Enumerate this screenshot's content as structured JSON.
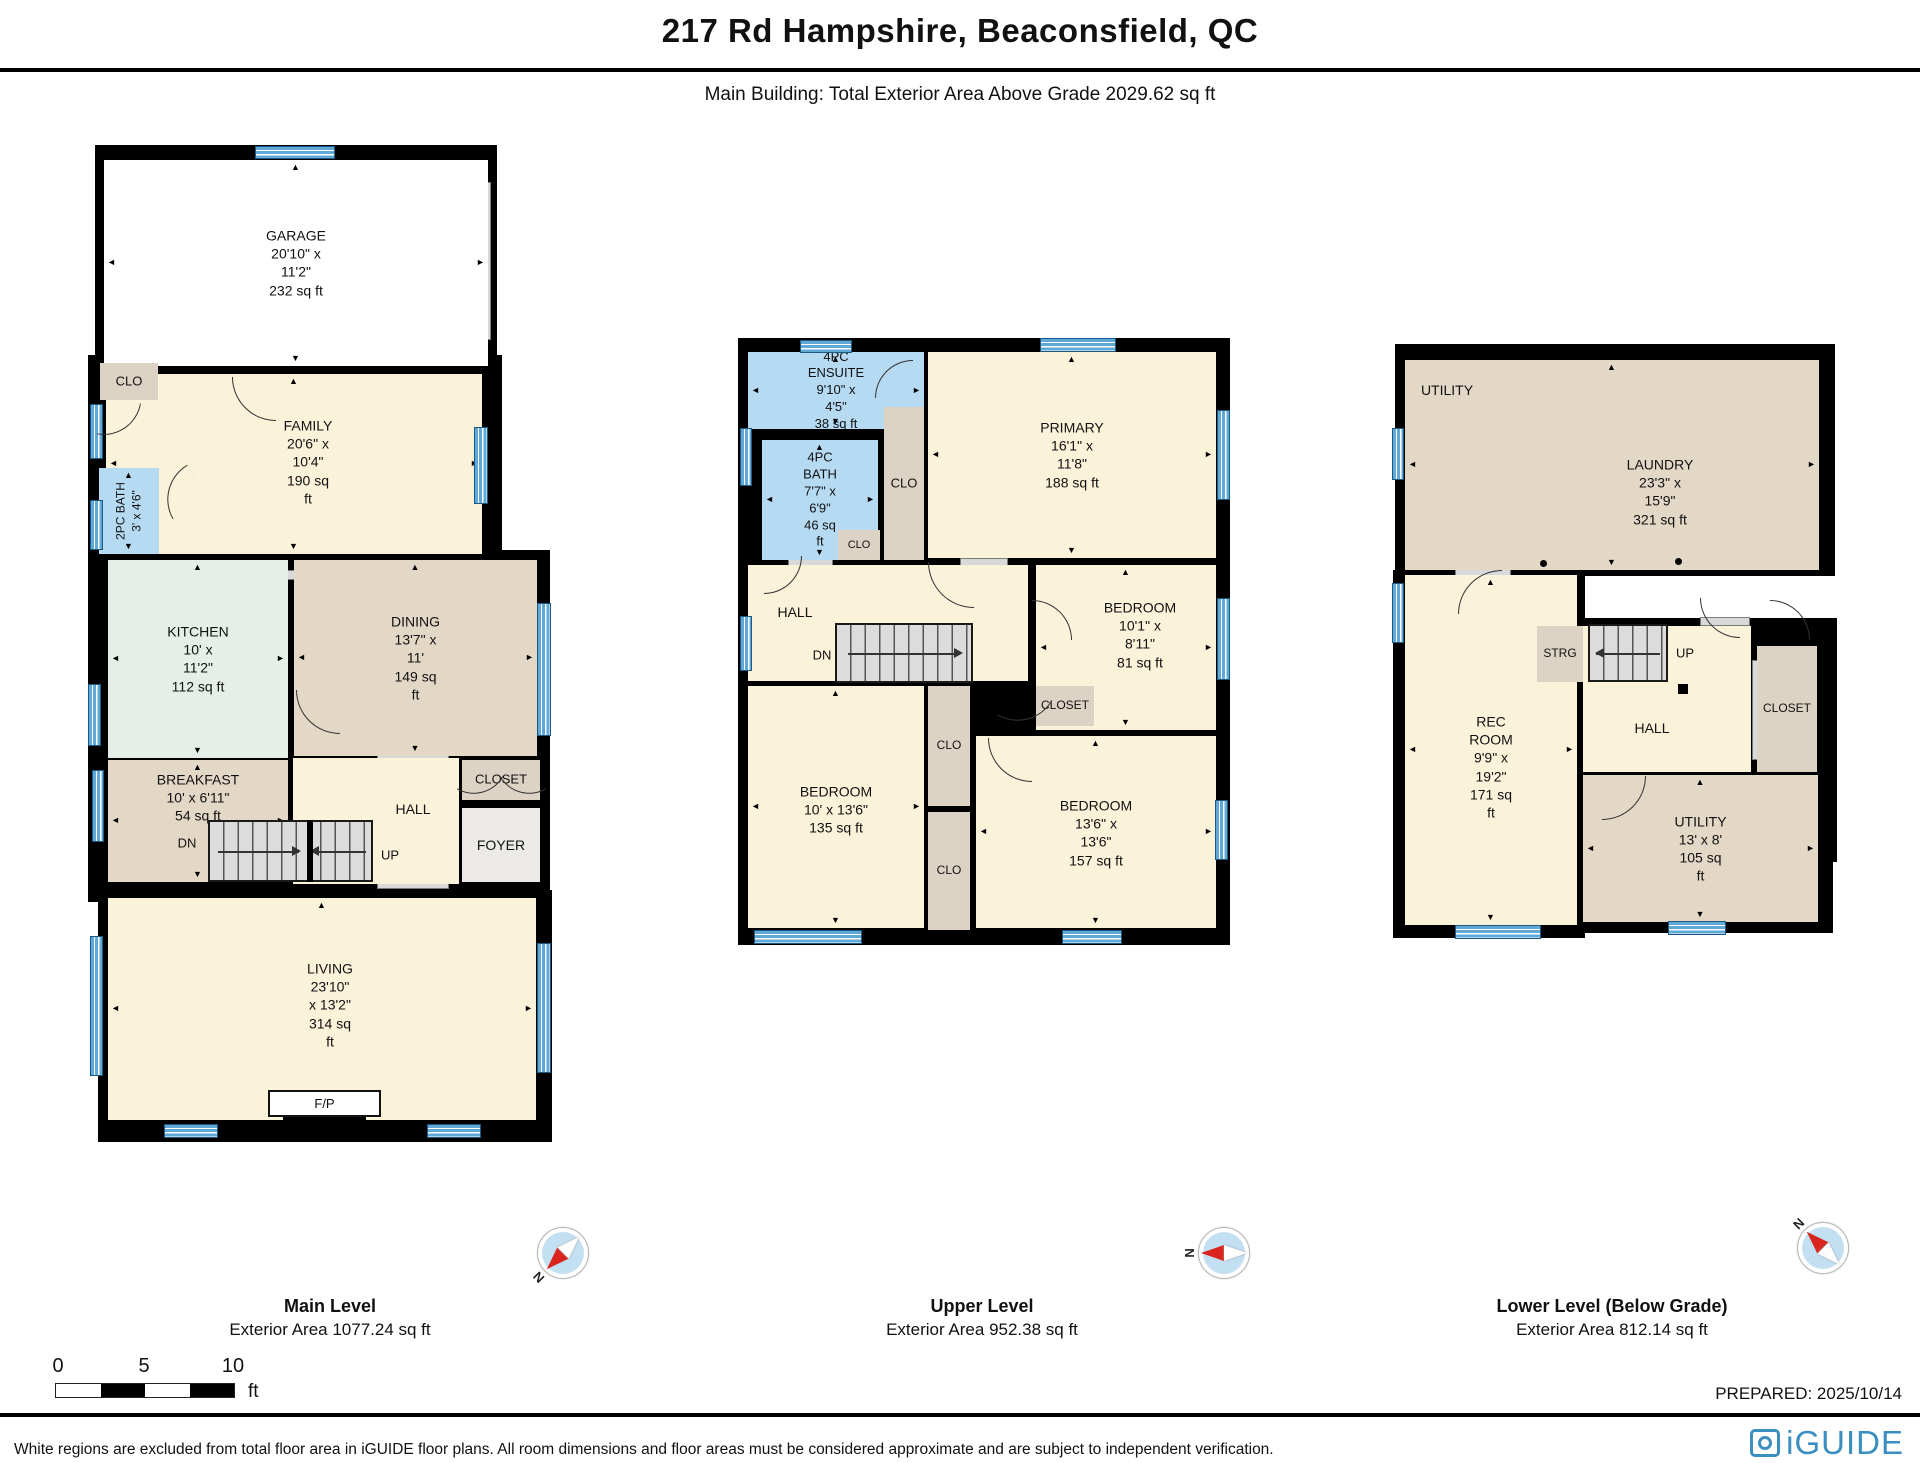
{
  "header": {
    "title": "217 Rd Hampshire, Beaconsfield, QC",
    "subtitle": "Main Building: Total Exterior Area Above Grade 2029.62 sq ft"
  },
  "colors": {
    "wall": "#000000",
    "white": "#ffffff",
    "cream": "#fbf2da",
    "tan": "#e3d8c6",
    "closet": "#ddd3c5",
    "mint": "#e6eee8",
    "blue": "#b5daf2",
    "gray": "#eceae6",
    "window_blue": "#5fa8d8",
    "accent_red": "#d9251d",
    "brand_blue": "#3a8fc0"
  },
  "compass_n": "N",
  "scale_bar": {
    "t0": "0",
    "t1": "5",
    "t2": "10",
    "unit": "ft"
  },
  "prepared": "PREPARED: 2025/10/14",
  "footer": {
    "disclaimer": "White regions are excluded from total floor area in iGUIDE floor plans. All room dimensions and floor areas must be considered approximate and are subject to independent verification.",
    "logo_text": "iGUIDE"
  },
  "levels": [
    {
      "id": "main",
      "caption": {
        "name": "Main Level",
        "area": "Exterior Area 1077.24 sq ft"
      },
      "backdrops": [
        [
          95,
          145,
          402,
          230
        ],
        [
          88,
          355,
          414,
          230
        ],
        [
          88,
          550,
          462,
          352
        ],
        [
          98,
          890,
          454,
          252
        ]
      ],
      "rooms": [
        {
          "n": "garage",
          "r": [
            104,
            160,
            384,
            206
          ],
          "f": "white",
          "l": [
            "GARAGE",
            "20'10\" x 11'2\"",
            "232 sq ft"
          ],
          "a": 1
        },
        {
          "n": "family",
          "r": [
            106,
            374,
            376,
            180
          ],
          "f": "cream",
          "l": [
            "FAMILY",
            "20'6\" x 10'4\"",
            "190 sq ft"
          ],
          "a": 1,
          "lx": 308,
          "ly": 462
        },
        {
          "n": "clo-main",
          "r": [
            100,
            363,
            58,
            37
          ],
          "f": "closet",
          "l": [
            "CLO"
          ],
          "fs": 13
        },
        {
          "n": "2pc-bath",
          "r": [
            99,
            468,
            60,
            86
          ],
          "f": "blue",
          "l": [
            "2PC BATH",
            "3' x 4'6\""
          ],
          "fs": 12,
          "v": 1,
          "a": 2
        },
        {
          "n": "kitchen",
          "r": [
            108,
            560,
            180,
            198
          ],
          "f": "mint",
          "l": [
            "KITCHEN",
            "10' x 11'2\"",
            "112 sq ft"
          ],
          "a": 1
        },
        {
          "n": "dining",
          "r": [
            294,
            560,
            243,
            196
          ],
          "f": "tan",
          "l": [
            "DINING",
            "13'7\" x 11'",
            "149 sq ft"
          ],
          "a": 1
        },
        {
          "n": "breakfast",
          "r": [
            108,
            760,
            180,
            122
          ],
          "f": "tan",
          "l": [
            "BREAKFAST",
            "10' x 6'11\"",
            "54 sq ft"
          ],
          "a": 1,
          "ly": 798
        },
        {
          "n": "hall-main",
          "r": [
            293,
            758,
            166,
            126
          ],
          "f": "cream",
          "l": [
            "HALL"
          ],
          "lx": 413,
          "ly": 809
        },
        {
          "n": "closet-main",
          "r": [
            462,
            760,
            78,
            40
          ],
          "f": "closet",
          "l": [
            "CLOSET"
          ],
          "fs": 13
        },
        {
          "n": "foyer",
          "r": [
            462,
            808,
            78,
            74
          ],
          "f": "gray",
          "l": [
            "FOYER"
          ],
          "ly": 845
        },
        {
          "n": "living",
          "r": [
            108,
            898,
            428,
            222
          ],
          "f": "cream",
          "l": [
            "LIVING",
            "23'10\" x 13'2\"",
            "314 sq ft"
          ],
          "a": 1,
          "lx": 330,
          "ly": 1005
        }
      ],
      "windows": [
        [
          255,
          146,
          80,
          13
        ],
        [
          90,
          404,
          13,
          55
        ],
        [
          90,
          500,
          13,
          50
        ],
        [
          88,
          684,
          13,
          62
        ],
        [
          92,
          770,
          12,
          72
        ],
        [
          90,
          936,
          13,
          140
        ],
        [
          474,
          427,
          14,
          77
        ],
        [
          537,
          603,
          14,
          133
        ],
        [
          537,
          943,
          14,
          130
        ],
        [
          164,
          1124,
          54,
          14
        ],
        [
          427,
          1124,
          54,
          14
        ]
      ],
      "grays": [
        [
          478,
          182,
          13,
          158
        ],
        [
          158,
          344,
          52,
          18
        ],
        [
          262,
          570,
          58,
          10
        ],
        [
          377,
          750,
          72,
          9
        ],
        [
          377,
          880,
          72,
          9
        ]
      ],
      "stairs": [
        {
          "r": [
            208,
            820,
            165,
            62
          ],
          "flights": [
            {
              "dir": "right",
              "w": 0.6
            },
            {
              "dir": "left",
              "w": 0.4
            }
          ],
          "div": 0.6
        }
      ],
      "texts": [
        {
          "t": "DN",
          "x": 187,
          "y": 843
        },
        {
          "t": "UP",
          "x": 390,
          "y": 855
        }
      ],
      "arcs": [
        [
          232,
          377,
          44,
          0
        ],
        [
          100,
          400,
          38,
          280
        ],
        [
          160,
          472,
          40,
          60
        ],
        [
          296,
          690,
          44,
          0
        ],
        [
          463,
          766,
          34,
          300
        ],
        [
          506,
          766,
          34,
          330
        ]
      ],
      "fp": {
        "box": [
          268,
          1090,
          113,
          27
        ],
        "strip": [
          283,
          1117,
          83,
          14
        ],
        "label": "F/P"
      },
      "posts": [],
      "dots": []
    },
    {
      "id": "upper",
      "caption": {
        "name": "Upper Level",
        "area": "Exterior Area 952.38 sq ft"
      },
      "backdrops": [
        [
          738,
          338,
          492,
          607
        ]
      ],
      "rooms": [
        {
          "n": "ensuite",
          "r": [
            748,
            352,
            176,
            77
          ],
          "f": "blue",
          "l": [
            "4PC ENSUITE",
            "9'10\" x 4'5\"",
            "38 sq ft"
          ],
          "fs": 13,
          "a": 1
        },
        {
          "n": "4pc-bath",
          "r": [
            762,
            440,
            116,
            120
          ],
          "f": "blue",
          "l": [
            "4PC BATH",
            "7'7\" x 6'9\"",
            "46 sq ft"
          ],
          "fs": 13,
          "a": 1
        },
        {
          "n": "clo-vert",
          "r": [
            884,
            407,
            40,
            153
          ],
          "f": "closet",
          "l": [
            "CLO"
          ],
          "fs": 13
        },
        {
          "n": "clo-small",
          "r": [
            838,
            530,
            42,
            30
          ],
          "f": "closet",
          "l": [
            "CLO"
          ],
          "fs": 11
        },
        {
          "n": "primary",
          "r": [
            928,
            352,
            288,
            206
          ],
          "f": "cream",
          "l": [
            "PRIMARY",
            "16'1\" x 11'8\"",
            "188 sq ft"
          ],
          "a": 1
        },
        {
          "n": "hall-upper",
          "r": [
            748,
            565,
            280,
            116
          ],
          "f": "cream",
          "l": [
            "HALL"
          ],
          "lx": 795,
          "ly": 612
        },
        {
          "n": "bedroom-small",
          "r": [
            1036,
            565,
            180,
            165
          ],
          "f": "cream",
          "l": [
            "BEDROOM",
            "10'1\" x 8'11\"",
            "81 sq ft"
          ],
          "a": 1,
          "lx": 1140,
          "ly": 635
        },
        {
          "n": "closet-upper",
          "r": [
            1036,
            686,
            58,
            40
          ],
          "f": "closet",
          "l": [
            "CLOSET"
          ],
          "fs": 12
        },
        {
          "n": "clo-mid1",
          "r": [
            928,
            686,
            42,
            120
          ],
          "f": "closet",
          "l": [
            "CLO"
          ],
          "fs": 12
        },
        {
          "n": "clo-mid2",
          "r": [
            928,
            812,
            42,
            118
          ],
          "f": "closet",
          "l": [
            "CLO"
          ],
          "fs": 12
        },
        {
          "n": "bedroom-left",
          "r": [
            748,
            686,
            176,
            242
          ],
          "f": "cream",
          "l": [
            "BEDROOM",
            "10' x 13'6\"",
            "135 sq ft"
          ],
          "a": 1,
          "ly": 810
        },
        {
          "n": "bedroom-big",
          "r": [
            976,
            736,
            240,
            192
          ],
          "f": "cream",
          "l": [
            "BEDROOM",
            "13'6\" x 13'6\"",
            "157 sq ft"
          ],
          "a": 1,
          "ly": 833
        }
      ],
      "windows": [
        [
          800,
          340,
          52,
          13
        ],
        [
          1040,
          338,
          76,
          14
        ],
        [
          740,
          428,
          12,
          58
        ],
        [
          740,
          616,
          12,
          55
        ],
        [
          1217,
          410,
          13,
          90
        ],
        [
          1217,
          598,
          13,
          82
        ],
        [
          1215,
          800,
          13,
          60
        ],
        [
          754,
          930,
          108,
          14
        ],
        [
          1062,
          930,
          60,
          14
        ]
      ],
      "grays": [
        [
          788,
          558,
          45,
          9
        ],
        [
          960,
          558,
          48,
          9
        ],
        [
          1040,
          680,
          50,
          8
        ]
      ],
      "stairs": [
        {
          "r": [
            835,
            623,
            138,
            60
          ],
          "flights": [
            {
              "dir": "right",
              "w": 1
            }
          ]
        }
      ],
      "texts": [
        {
          "t": "DN",
          "x": 822,
          "y": 655
        }
      ],
      "arcs": [
        [
          928,
          562,
          46,
          0
        ],
        [
          764,
          556,
          38,
          270
        ],
        [
          875,
          360,
          38,
          90
        ],
        [
          1032,
          600,
          40,
          180
        ],
        [
          1005,
          688,
          40,
          300
        ],
        [
          988,
          738,
          44,
          0
        ]
      ],
      "posts": [],
      "dots": []
    },
    {
      "id": "lower",
      "caption": {
        "name": "Lower Level (Below Grade)",
        "area": "Exterior Area 812.14 sq ft"
      },
      "backdrops": [
        [
          1395,
          344,
          440,
          232
        ],
        [
          1393,
          570,
          192,
          368
        ],
        [
          1578,
          618,
          259,
          244
        ],
        [
          1578,
          768,
          255,
          165
        ]
      ],
      "rooms": [
        {
          "n": "laundry",
          "r": [
            1405,
            360,
            414,
            210
          ],
          "f": "tan",
          "l": [
            "LAUNDRY",
            "23'3\" x 15'9\"",
            "321 sq ft"
          ],
          "a": 1,
          "lx": 1660,
          "ly": 492
        },
        {
          "n": "rec-room",
          "r": [
            1405,
            575,
            172,
            350
          ],
          "f": "cream",
          "l": [
            "REC ROOM",
            "9'9\" x 19'2\"",
            "171 sq ft"
          ],
          "a": 1,
          "ly": 767
        },
        {
          "n": "strg",
          "r": [
            1537,
            626,
            46,
            56
          ],
          "f": "closet",
          "l": [
            "STRG"
          ],
          "fs": 12
        },
        {
          "n": "hall-lower",
          "r": [
            1583,
            626,
            168,
            146
          ],
          "f": "cream",
          "l": [
            "HALL"
          ],
          "lx": 1652,
          "ly": 728
        },
        {
          "n": "closet-lower",
          "r": [
            1757,
            646,
            60,
            126
          ],
          "f": "closet",
          "l": [
            "CLOSET"
          ],
          "fs": 12
        },
        {
          "n": "utility-lower",
          "r": [
            1583,
            775,
            235,
            147
          ],
          "f": "tan",
          "l": [
            "UTILITY",
            "13' x 8'",
            "105 sq ft"
          ],
          "a": 1
        }
      ],
      "windows": [
        [
          1392,
          428,
          12,
          52
        ],
        [
          1392,
          583,
          12,
          60
        ],
        [
          1455,
          925,
          86,
          14
        ],
        [
          1668,
          921,
          58,
          14
        ]
      ],
      "grays": [
        [
          1752,
          660,
          6,
          100
        ],
        [
          1455,
          567,
          56,
          9
        ],
        [
          1700,
          617,
          50,
          9
        ]
      ],
      "stairs": [
        {
          "r": [
            1588,
            624,
            80,
            58
          ],
          "flights": [
            {
              "dir": "left",
              "w": 1
            }
          ]
        }
      ],
      "texts": [
        {
          "t": "UP",
          "x": 1685,
          "y": 653
        },
        {
          "t": "UTILITY",
          "x": 1447,
          "y": 390,
          "fs": 14
        }
      ],
      "arcs": [
        [
          1458,
          570,
          44,
          90
        ],
        [
          1700,
          598,
          40,
          0
        ],
        [
          1602,
          776,
          44,
          270
        ],
        [
          1770,
          600,
          40,
          180
        ]
      ],
      "posts": [
        [
          1678,
          684,
          10,
          10
        ]
      ],
      "dots": [
        [
          1540,
          560
        ],
        [
          1675,
          558
        ]
      ]
    }
  ]
}
